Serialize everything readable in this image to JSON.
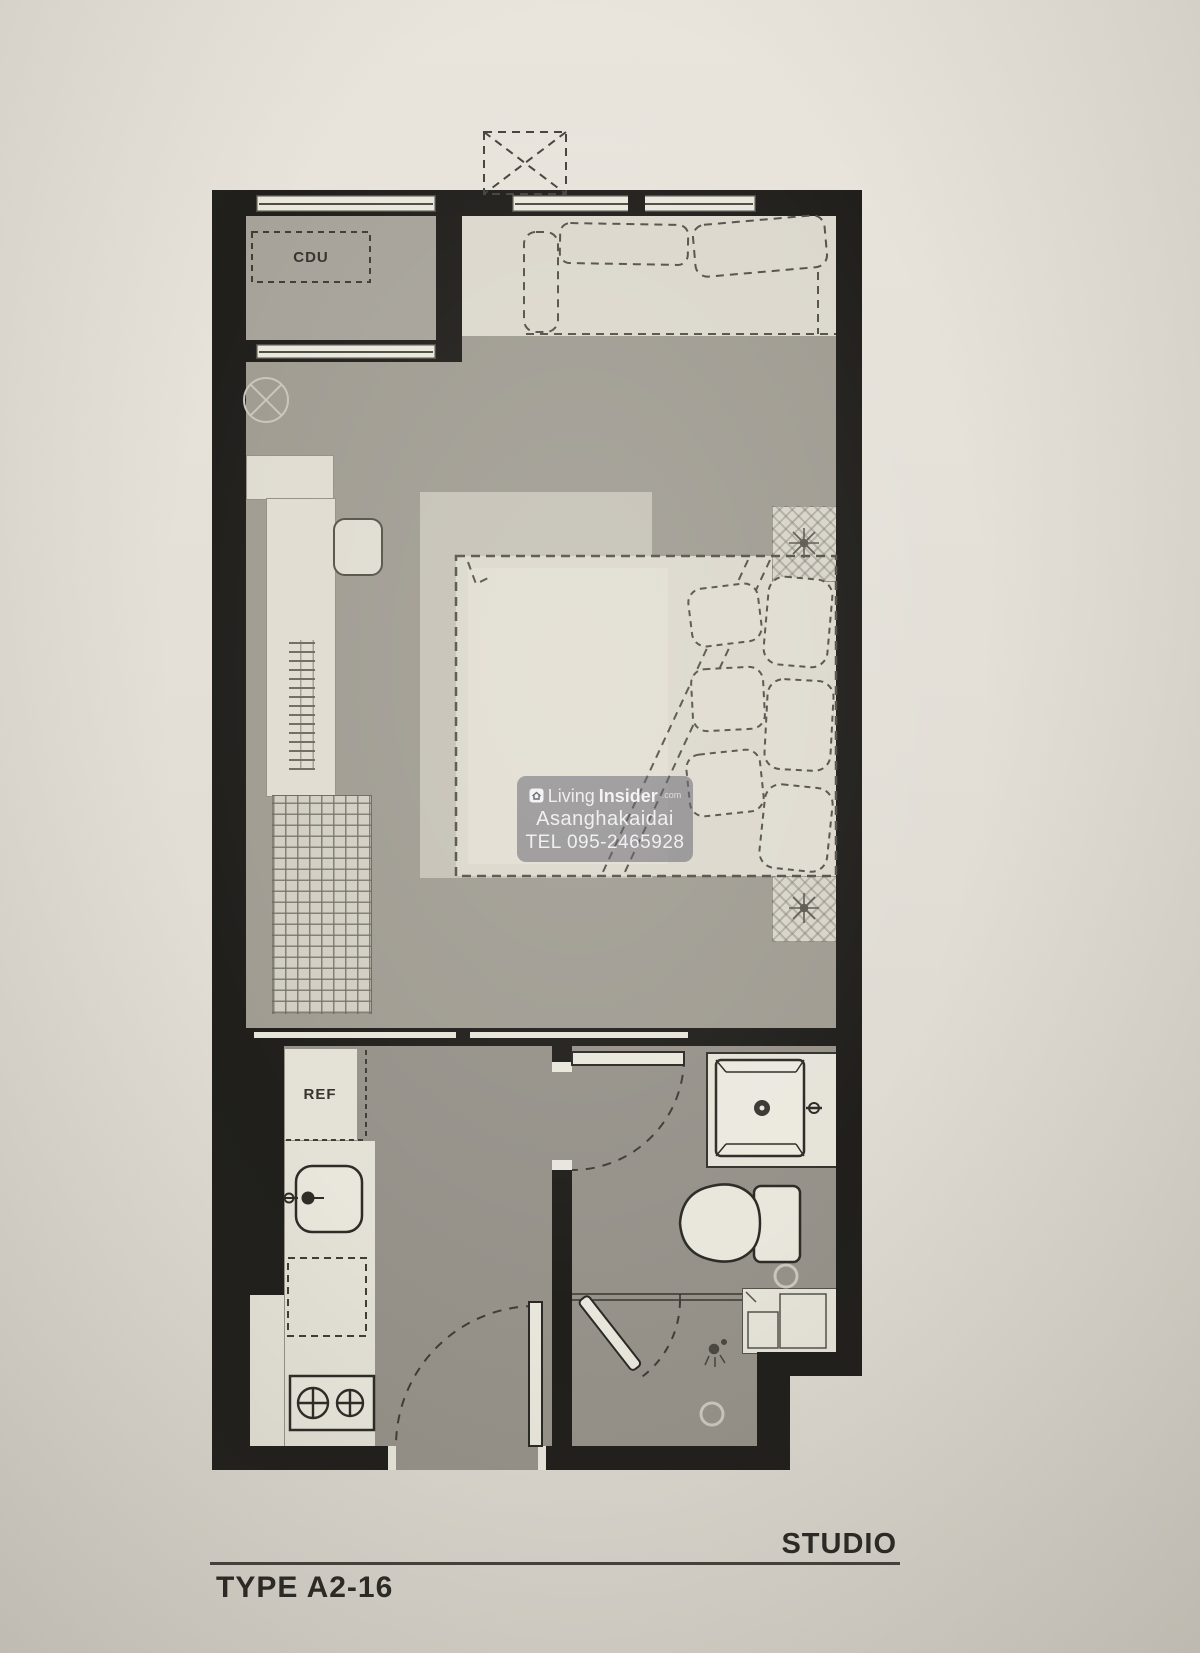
{
  "plan": {
    "unit_type": "STUDIO",
    "type_code": "TYPE A2-16",
    "labels": {
      "cdu": "CDU",
      "ref": "REF"
    }
  },
  "watermark": {
    "logo_icon": "house-cube-icon",
    "brand_prefix": "Living",
    "brand_suffix": "Insider",
    "brand_tld": ".com",
    "line2": "Asanghakaidai",
    "line3": "TEL 095-2465928"
  },
  "colors": {
    "paper": "#e3dfd7",
    "wall": "#201f1c",
    "floor_living": "#a09c92",
    "floor_balcony": "#a7a39a",
    "floor_service": "#96928a",
    "furniture_cream": "#dedacf",
    "rug": "#c6c2b7",
    "watermark_bg": "rgba(94,94,106,0.55)",
    "text_dark": "#2b2924"
  }
}
